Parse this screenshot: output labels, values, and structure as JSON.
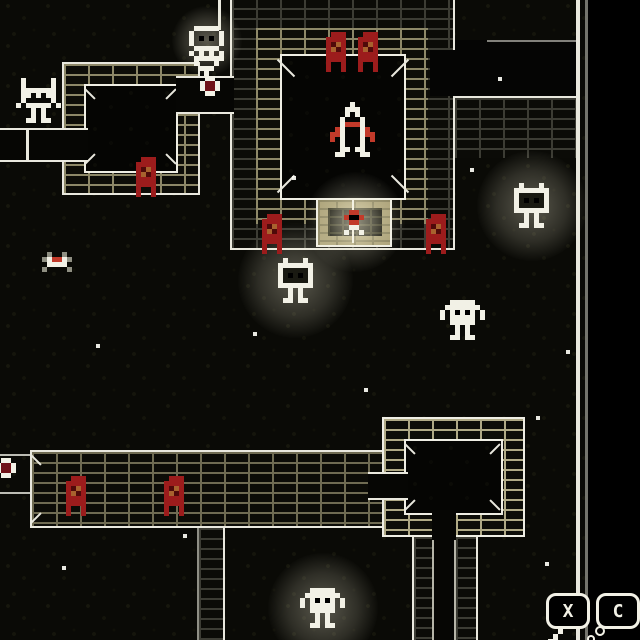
{
  "ui": {
    "button_x": "X",
    "button_c": "C"
  },
  "palette": {
    "white": "#f2f1e6",
    "line": "#e9e8de",
    "red": "#9c1c1c",
    "red_bright": "#c23a2a",
    "red_deep": "#4f0a0a",
    "ember": "#a8622e",
    "maroon": "#701218",
    "face": "#1a1a12",
    "black": "#000000",
    "gray": "#8f8f82",
    "tan": "#a89e74",
    "background": "#0a0a06",
    "void": "#000000"
  },
  "entities": [
    {
      "type": "rocket",
      "x": 330,
      "y": 102
    },
    {
      "type": "banner",
      "x": 326,
      "y": 32
    },
    {
      "type": "banner",
      "x": 358,
      "y": 32
    },
    {
      "type": "banner",
      "x": 262,
      "y": 214
    },
    {
      "type": "banner",
      "x": 426,
      "y": 214
    },
    {
      "type": "banner",
      "x": 136,
      "y": 157
    },
    {
      "type": "banner",
      "x": 66,
      "y": 476
    },
    {
      "type": "banner",
      "x": 164,
      "y": 476
    },
    {
      "type": "glowbot",
      "x": 514,
      "y": 183,
      "glow": 110
    },
    {
      "type": "glowbot",
      "x": 278,
      "y": 258,
      "glow": 115
    },
    {
      "type": "blob",
      "x": 440,
      "y": 300
    },
    {
      "type": "blob",
      "x": 300,
      "y": 588,
      "glow": 110
    },
    {
      "type": "robot",
      "x": 16,
      "y": 78
    },
    {
      "type": "watcher",
      "x": 189,
      "y": 26,
      "glow": 70
    },
    {
      "type": "pedestal",
      "x": 189,
      "y": 56
    },
    {
      "type": "gem",
      "x": 200,
      "y": 76
    },
    {
      "type": "gem",
      "x": -4,
      "y": 458
    },
    {
      "type": "glowspot",
      "x": 355,
      "y": 222,
      "glow": 100
    },
    {
      "type": "imp",
      "x": 344,
      "y": 210,
      "glow": 55
    },
    {
      "type": "spider",
      "x": 42,
      "y": 252
    }
  ],
  "stars": [
    [
      292,
      176
    ],
    [
      498,
      77
    ],
    [
      96,
      344
    ],
    [
      566,
      350
    ],
    [
      183,
      534
    ],
    [
      545,
      562
    ],
    [
      62,
      566
    ],
    [
      364,
      388
    ],
    [
      253,
      332
    ],
    [
      470,
      168
    ],
    [
      536,
      416
    ]
  ]
}
